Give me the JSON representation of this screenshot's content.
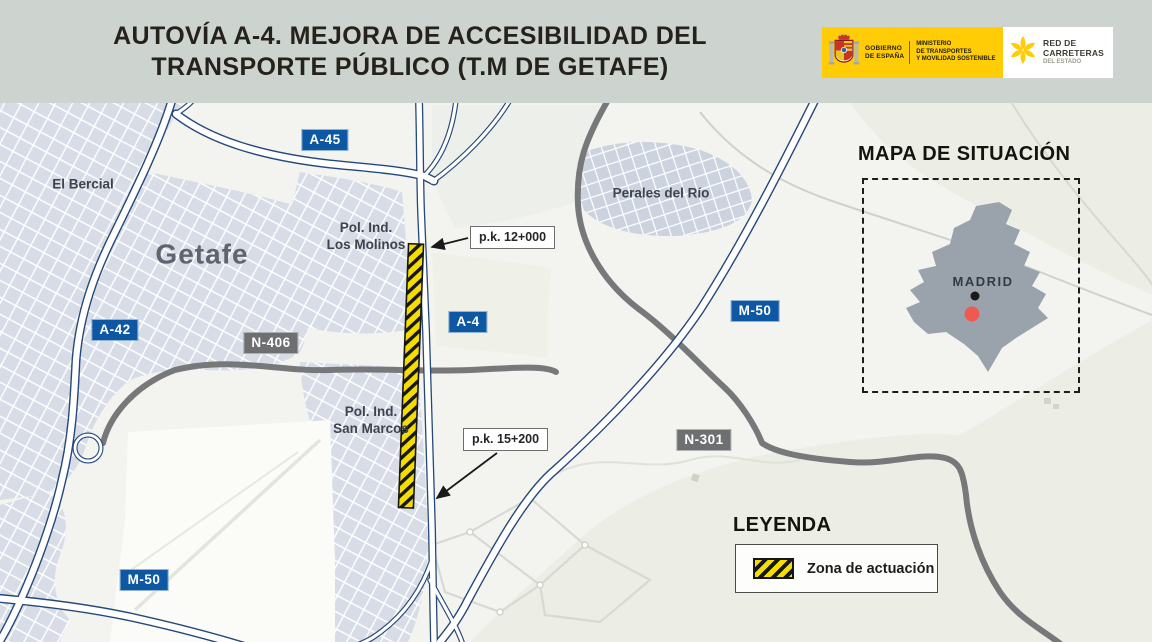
{
  "header": {
    "title_line1": "AUTOVÍA A-4. MEJORA DE ACCESIBILIDAD DEL",
    "title_line2": "TRANSPORTE PÚBLICO (T.M DE GETAFE)",
    "gobierno_line1": "GOBIERNO",
    "gobierno_line2": "DE ESPAÑA",
    "ministerio_line1": "MINISTERIO",
    "ministerio_line2": "DE TRANSPORTES",
    "ministerio_line3": "Y MOVILIDAD SOSTENIBLE",
    "red_line1": "RED DE",
    "red_line2": "CARRETERAS",
    "red_line3": "DEL ESTADO"
  },
  "map": {
    "places": {
      "el_bercial": "El Bercial",
      "getafe": "Getafe",
      "los_molinos_line1": "Pol. Ind.",
      "los_molinos_line2": "Los Molinos",
      "perales": "Perales del Río",
      "san_marcos_line1": "Pol. Ind.",
      "san_marcos_line2": "San Marcos"
    },
    "badges": {
      "a45": "A-45",
      "a42": "A-42",
      "a4": "A-4",
      "m50_east": "M-50",
      "m50_southwest": "M-50",
      "n406": "N-406",
      "n301": "N-301"
    },
    "markers": {
      "pk_start": "p.k. 12+000",
      "pk_end": "p.k. 15+200"
    }
  },
  "situation_map": {
    "title": "MAPA DE SITUACIÓN",
    "city_label": "MADRID"
  },
  "legend": {
    "title": "LEYENDA",
    "zona_label": "Zona de actuación"
  },
  "colors": {
    "header_background": "#cdd4d0",
    "motorway_badge_blue": "#0d57a3",
    "national_badge_gray": "#6d6f71",
    "work_zone_yellow": "#f5dd00",
    "location_dot_red": "#f0594f",
    "road_casing_blue": "#264879",
    "road_gray": "#76787a",
    "gov_logo_yellow": "#ffcc05"
  }
}
